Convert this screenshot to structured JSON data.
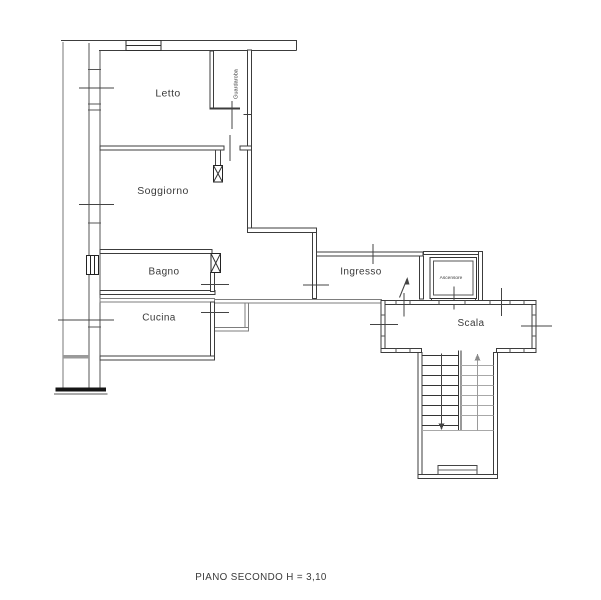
{
  "plan": {
    "caption": "PIANO SECONDO H = 3,10",
    "rooms": {
      "letto": "Letto",
      "soggiorno": "Soggiorno",
      "bagno": "Bagno",
      "cucina": "Cucina",
      "ingresso": "Ingresso",
      "guardaroba": "Guardaroba",
      "ascensore": "Ascensore",
      "scala": "Scala"
    },
    "colors": {
      "background": "#ffffff",
      "wall": "#3c3c3c",
      "wall_light": "#8f8f8f",
      "tread_light": "#a8a8a8",
      "text": "#333333"
    }
  }
}
